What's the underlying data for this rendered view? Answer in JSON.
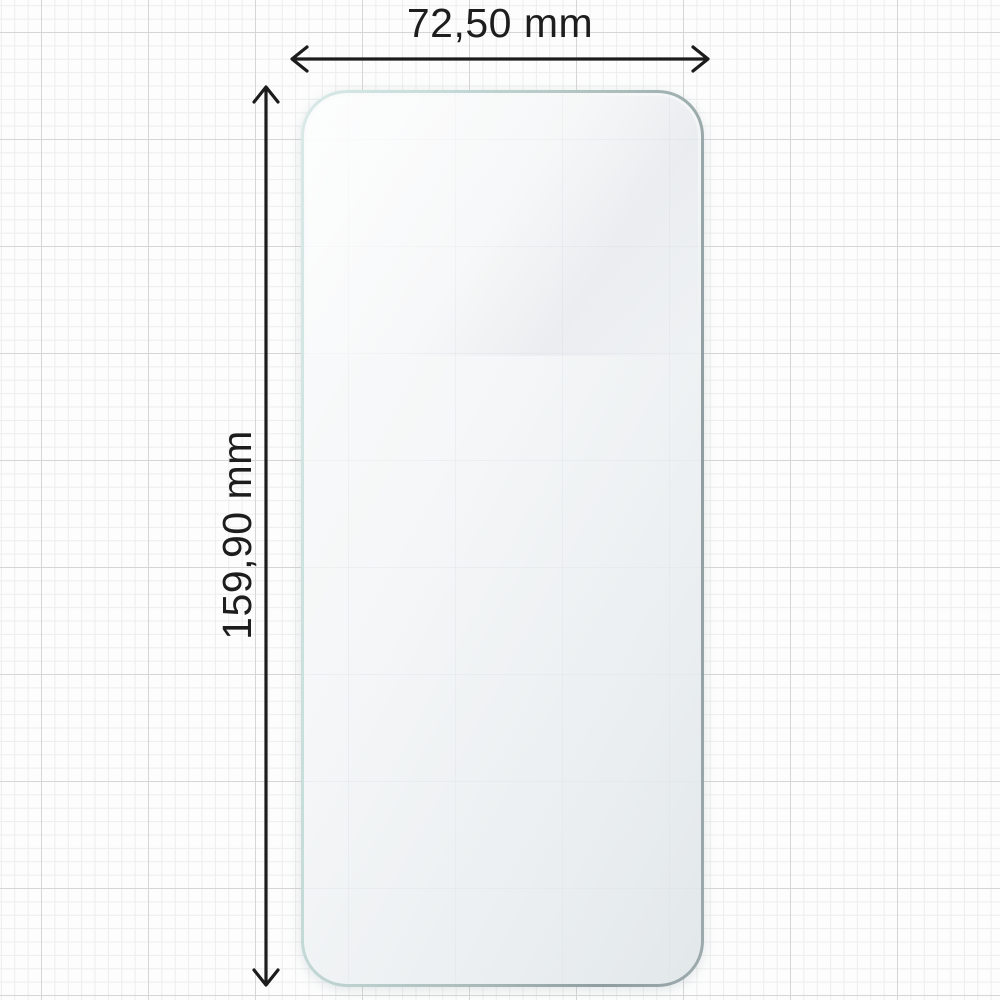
{
  "dimensions": {
    "width_label": "72,50 mm",
    "height_label": "159,90 mm"
  },
  "colors": {
    "arrow": "#1c1c1c",
    "label_text": "#1d1d1d",
    "background": "#fdfdfd",
    "grid_minor": "#ededed",
    "grid_major": "#d6d6d6",
    "protector_edge_teal": "#cfe4e2",
    "protector_edge_gray": "#93a1a5",
    "protector_fill": "#f4f6f7"
  }
}
